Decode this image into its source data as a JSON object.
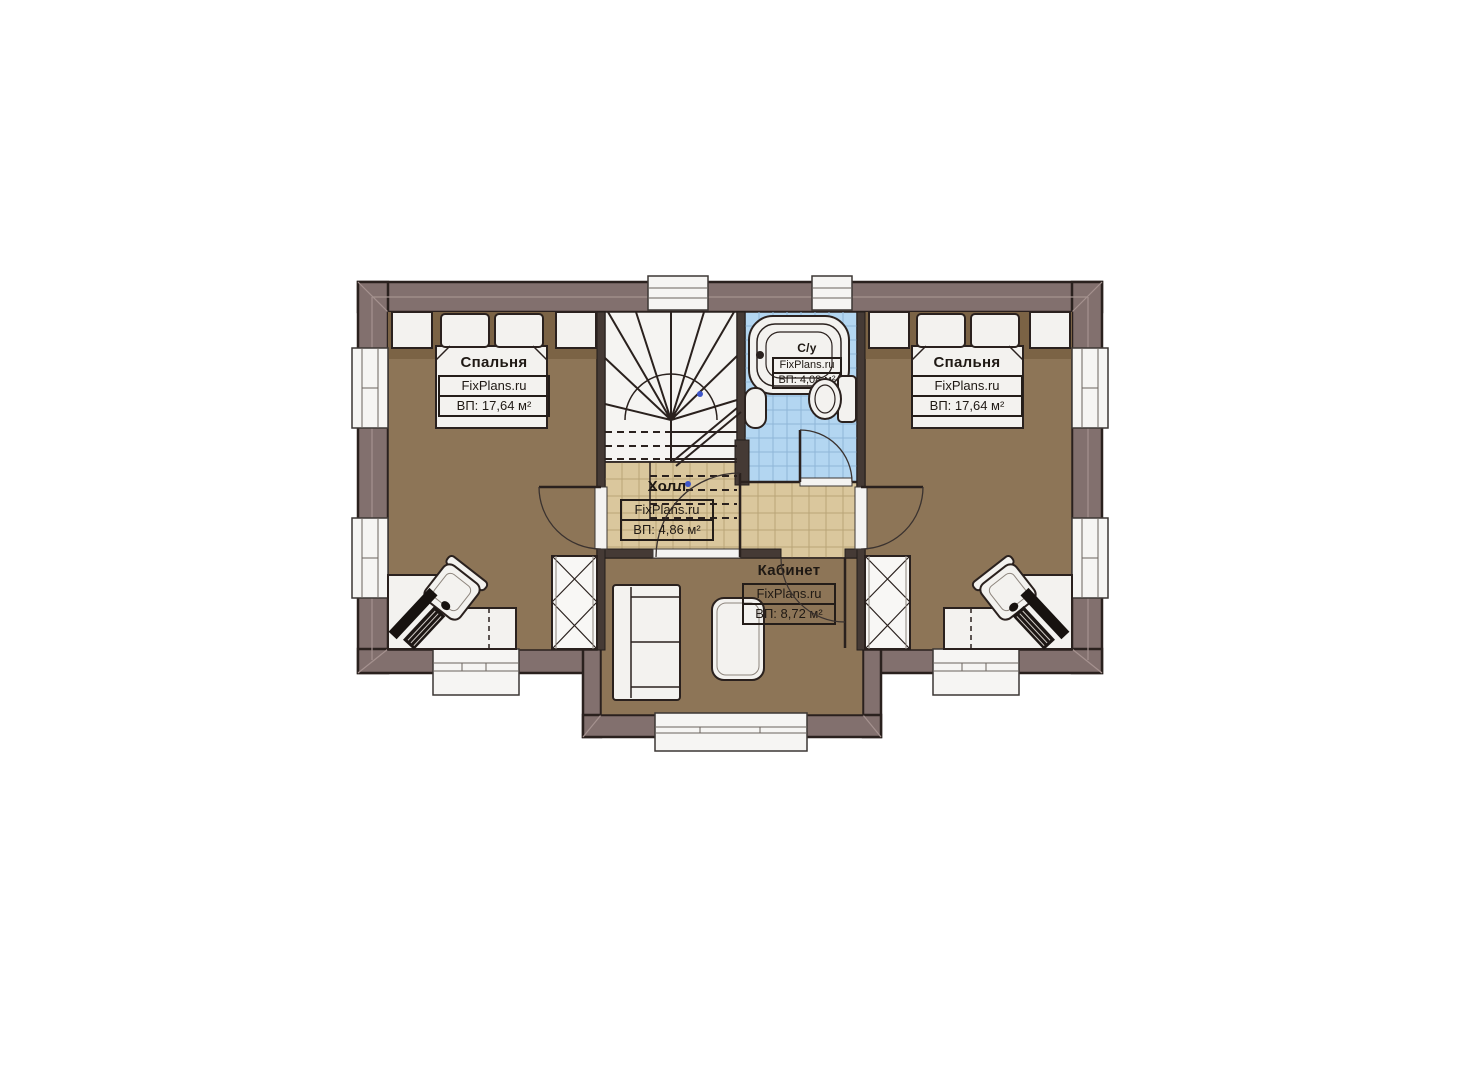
{
  "plan": {
    "rooms": [
      {
        "id": "bedroom-left",
        "name": "Спальня",
        "watermark": "FixPlans.ru",
        "area": "ВП: 17,64 м²"
      },
      {
        "id": "bedroom-right",
        "name": "Спальня",
        "watermark": "FixPlans.ru",
        "area": "ВП: 17,64 м²"
      },
      {
        "id": "bathroom",
        "name": "С/у",
        "watermark": "FixPlans.ru",
        "area": "ВП: 4,08 м²"
      },
      {
        "id": "hall",
        "name": "Холл",
        "watermark": "FixPlans.ru",
        "area": "ВП: 4,86 м²"
      },
      {
        "id": "study",
        "name": "Кабинет",
        "watermark": "FixPlans.ru",
        "area": "ВП: 8,72 м²"
      }
    ],
    "colors": {
      "wall": "#82706e",
      "outline": "#2a211e",
      "bedroom_floor": "#8d7557",
      "headboard_strip": "#7b6345",
      "hall_floor": "#dac79d",
      "bath_floor": "#b3d6f1",
      "furniture": "#f3f2ef"
    }
  }
}
